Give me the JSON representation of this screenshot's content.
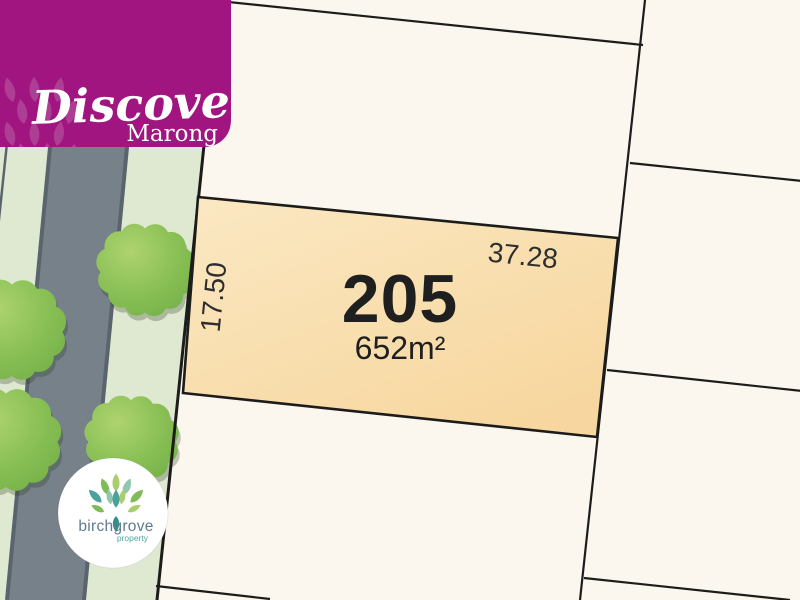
{
  "badge": {
    "title": "Discover",
    "subtitle": "Marong",
    "bg_color": "#A0157F",
    "petal_color": "#AD3E94",
    "text_color": "#FFFFFF"
  },
  "lot": {
    "number": "205",
    "area": "652m²",
    "frontage": "37.28",
    "depth": "17.50",
    "fill_light": "#FBE8C3",
    "fill_dark": "#F7D79F",
    "outline_color": "#1C1C1B",
    "label_color": "#1F1F1F",
    "dim_color": "#2E2E2E"
  },
  "map": {
    "background_color": "#FBF7EF",
    "road_color": "#76818A",
    "kerb_color": "#5A646D",
    "verge_color": "#DFE9D1",
    "tree_light": "#AED36F",
    "tree_mid": "#8AC056",
    "tree_dark": "#72B046",
    "boundary_color": "#1C1C1B"
  },
  "logo": {
    "name": "birchgrove",
    "tagline": "property",
    "name_color": "#5F7B8C",
    "tagline_color": "#4FA79D",
    "circle_color": "#FFFFFF",
    "leaf_colors": {
      "teal": "#4AA39A",
      "seafoam": "#8FC8AF",
      "light_green": "#A9CE6C",
      "green": "#7FBC58",
      "dark_teal": "#2F9188"
    }
  }
}
